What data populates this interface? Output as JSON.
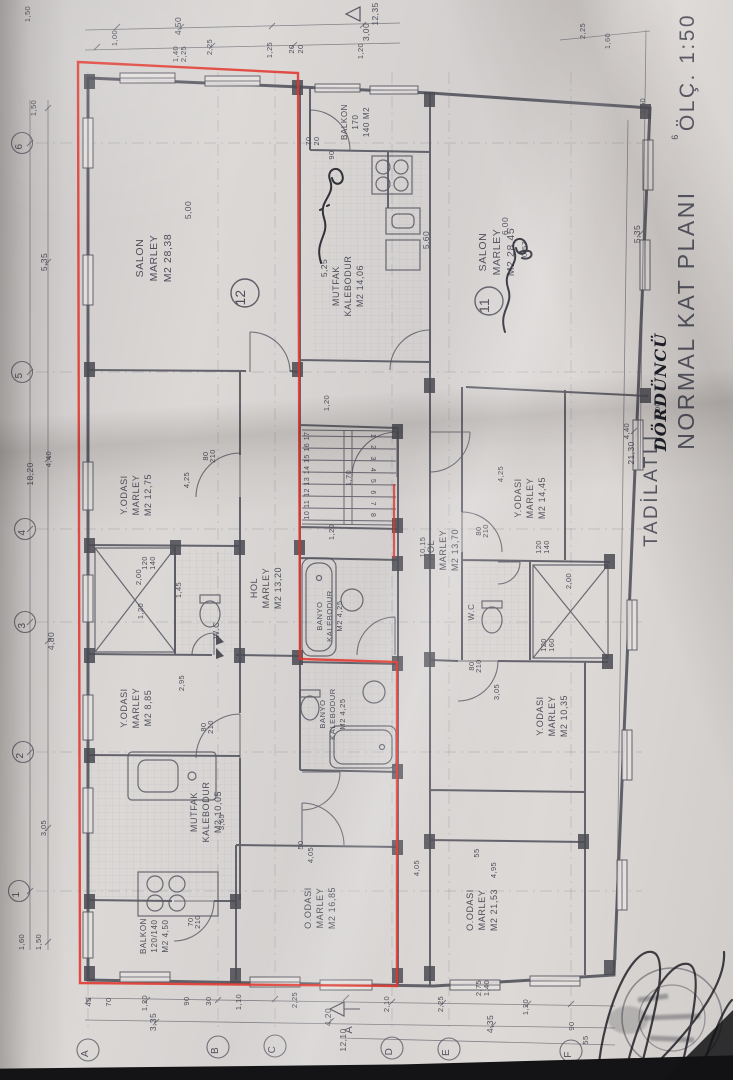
{
  "title": {
    "prefix": "TADİLATLI",
    "handwritten": "DÖRDÜNCÜ",
    "main": "NORMAL KAT PLANI",
    "scale": "ÖLÇ. 1:50"
  },
  "section_marker": {
    "label": "A"
  },
  "apartment_units": [
    {
      "number": "12",
      "x": 245,
      "y": 293
    },
    {
      "number": "11",
      "x": 489,
      "y": 301
    }
  ],
  "rooms": [
    {
      "name": "SALON",
      "material": "MARLEY",
      "area": "M2 28,38",
      "x": 143,
      "y": 258,
      "s": 10.5,
      "lh": 14
    },
    {
      "name": "Y.ODASI",
      "material": "MARLEY",
      "area": "M2 12,75",
      "x": 127,
      "y": 495,
      "s": 9,
      "lh": 12
    },
    {
      "name": "HOL",
      "material": "MARLEY",
      "area": "M2 13,20",
      "x": 257,
      "y": 588,
      "s": 9,
      "lh": 12
    },
    {
      "name": "Y.ODASI",
      "material": "MARLEY",
      "area": "M2 8,85",
      "x": 127,
      "y": 708,
      "s": 9,
      "lh": 12
    },
    {
      "name": "MUTFAK",
      "material": "KALEBODUR",
      "area": "M2 10,05",
      "x": 197,
      "y": 812,
      "s": 9,
      "lh": 12
    },
    {
      "name": "BALKON",
      "material": "120/140",
      "area": "M2 4,50",
      "x": 146,
      "y": 936,
      "s": 8,
      "lh": 11
    },
    {
      "name": "O.ODASI",
      "material": "MARLEY",
      "area": "M2 16,85",
      "x": 311,
      "y": 908,
      "s": 9,
      "lh": 12
    },
    {
      "name": "BALKON",
      "material": "170",
      "area": "140 M2",
      "x": 347,
      "y": 122,
      "s": 8,
      "lh": 11
    },
    {
      "name": "MUTFAK",
      "material": "KALEBODUR",
      "area": "M2 14,06",
      "x": 339,
      "y": 286,
      "s": 9,
      "lh": 12
    },
    {
      "name": "BANYO",
      "material": "KALEBODUR",
      "area": "M2 4,25",
      "x": 322,
      "y": 616,
      "s": 7.5,
      "lh": 10
    },
    {
      "name": "BANYO",
      "material": "KALEBODUR",
      "area": "M2 4,25",
      "x": 325,
      "y": 714,
      "s": 7.5,
      "lh": 10
    },
    {
      "name": "W.C",
      "material": "",
      "area": "",
      "x": 219,
      "y": 630,
      "s": 8,
      "lh": 10
    },
    {
      "name": "SALON",
      "material": "MARLEY",
      "area": "M2 28,45",
      "x": 486,
      "y": 252,
      "s": 10.5,
      "lh": 14
    },
    {
      "name": "HOL",
      "material": "MARLEY",
      "area": "M2 13,70",
      "x": 434,
      "y": 550,
      "s": 9,
      "lh": 12
    },
    {
      "name": "Y.ODASI",
      "material": "MARLEY",
      "area": "M2 14,45",
      "x": 521,
      "y": 498,
      "s": 9,
      "lh": 12
    },
    {
      "name": "Y.ODASI",
      "material": "MARLEY",
      "area": "M2 10,35",
      "x": 543,
      "y": 716,
      "s": 9,
      "lh": 12
    },
    {
      "name": "O.ODASI",
      "material": "MARLEY",
      "area": "M2 21,53",
      "x": 473,
      "y": 910,
      "s": 9,
      "lh": 12
    },
    {
      "name": "W.C",
      "material": "",
      "area": "",
      "x": 474,
      "y": 612,
      "s": 8,
      "lh": 10
    }
  ],
  "dimensions": [
    {
      "t": "1,50",
      "x": 30,
      "y": 14
    },
    {
      "t": "1,00",
      "x": 117,
      "y": 38
    },
    {
      "t": "4,50",
      "x": 181,
      "y": 26,
      "s": 8.5
    },
    {
      "t": "2,25",
      "x": 212,
      "y": 47
    },
    {
      "t": "2,25",
      "x": 186,
      "y": 54
    },
    {
      "t": "1,40",
      "x": 178,
      "y": 54
    },
    {
      "t": "1,25",
      "x": 272,
      "y": 50
    },
    {
      "t": "20",
      "x": 294,
      "y": 49
    },
    {
      "t": "20",
      "x": 303,
      "y": 49
    },
    {
      "t": "1,20",
      "x": 363,
      "y": 51
    },
    {
      "t": "3,00",
      "x": 369,
      "y": 32,
      "s": 8.5
    },
    {
      "t": "12,35",
      "x": 378,
      "y": 14,
      "s": 8.5
    },
    {
      "t": "2,25",
      "x": 585,
      "y": 31
    },
    {
      "t": "1,60",
      "x": 610,
      "y": 41
    },
    {
      "t": "1,50",
      "x": 645,
      "y": 106
    },
    {
      "t": "1,50",
      "x": 36,
      "y": 108
    },
    {
      "t": "5,35",
      "x": 47,
      "y": 262,
      "s": 8.5
    },
    {
      "t": "4,40",
      "x": 51,
      "y": 459
    },
    {
      "t": "18,20",
      "x": 33,
      "y": 474,
      "s": 8.5
    },
    {
      "t": "4,80",
      "x": 54,
      "y": 641,
      "s": 8.5
    },
    {
      "t": "3,05",
      "x": 46,
      "y": 828
    },
    {
      "t": "1,60",
      "x": 24,
      "y": 942
    },
    {
      "t": "1,50",
      "x": 41,
      "y": 942
    },
    {
      "t": "5,35",
      "x": 640,
      "y": 234,
      "s": 8.5
    },
    {
      "t": "4,40",
      "x": 629,
      "y": 431
    },
    {
      "t": "21,30",
      "x": 634,
      "y": 453,
      "s": 8.5
    },
    {
      "t": "6",
      "x": 678,
      "y": 137,
      "s": 9
    },
    {
      "t": "4,00",
      "x": 660,
      "y": 410
    },
    {
      "t": "45",
      "x": 91,
      "y": 1002
    },
    {
      "t": "70",
      "x": 111,
      "y": 1002
    },
    {
      "t": "1,20",
      "x": 147,
      "y": 1003
    },
    {
      "t": "90",
      "x": 189,
      "y": 1001
    },
    {
      "t": "30",
      "x": 211,
      "y": 1001
    },
    {
      "t": "1,10",
      "x": 241,
      "y": 1002
    },
    {
      "t": "2,25",
      "x": 297,
      "y": 1000
    },
    {
      "t": "3,35",
      "x": 156,
      "y": 1022,
      "s": 8.5
    },
    {
      "t": "4,20",
      "x": 331,
      "y": 1017,
      "s": 8.5
    },
    {
      "t": "12,10",
      "x": 346,
      "y": 1040,
      "s": 8.5
    },
    {
      "t": "2,10",
      "x": 389,
      "y": 1004
    },
    {
      "t": "2,25",
      "x": 443,
      "y": 1004
    },
    {
      "t": "1,20",
      "x": 528,
      "y": 1007
    },
    {
      "t": "4,35",
      "x": 493,
      "y": 1024,
      "s": 8.5
    },
    {
      "t": "90",
      "x": 574,
      "y": 1026
    },
    {
      "t": "55",
      "x": 588,
      "y": 1040
    },
    {
      "t": "2,75",
      "x": 481,
      "y": 988
    },
    {
      "t": "1,40",
      "x": 489,
      "y": 988
    },
    {
      "t": "5,00",
      "x": 191,
      "y": 210,
      "s": 8.5
    },
    {
      "t": "6,00",
      "x": 508,
      "y": 226,
      "s": 8.5
    },
    {
      "t": "0,57",
      "x": 527,
      "y": 249
    },
    {
      "t": "5,25",
      "x": 327,
      "y": 268,
      "s": 8.5
    },
    {
      "t": "5,60",
      "x": 429,
      "y": 240,
      "s": 8.5
    },
    {
      "t": "4,25",
      "x": 189,
      "y": 480
    },
    {
      "t": "2,95",
      "x": 184,
      "y": 683
    },
    {
      "t": "3,65",
      "x": 224,
      "y": 822
    },
    {
      "t": "4,05",
      "x": 313,
      "y": 855
    },
    {
      "t": "50",
      "x": 303,
      "y": 845
    },
    {
      "t": "4,25",
      "x": 503,
      "y": 474
    },
    {
      "t": "3,05",
      "x": 499,
      "y": 692
    },
    {
      "t": "4,05",
      "x": 419,
      "y": 868
    },
    {
      "t": "4,95",
      "x": 496,
      "y": 870
    },
    {
      "t": "55",
      "x": 479,
      "y": 853
    },
    {
      "t": "10,15",
      "x": 425,
      "y": 547
    },
    {
      "t": "1,20",
      "x": 329,
      "y": 403
    },
    {
      "t": "1,70",
      "x": 351,
      "y": 478
    },
    {
      "t": "1,20",
      "x": 334,
      "y": 532
    },
    {
      "t": "2,00",
      "x": 141,
      "y": 577
    },
    {
      "t": "1,20",
      "x": 143,
      "y": 611
    },
    {
      "t": "1,45",
      "x": 181,
      "y": 590
    },
    {
      "t": "120",
      "x": 147,
      "y": 563
    },
    {
      "t": "140",
      "x": 155,
      "y": 563
    },
    {
      "t": "2,00",
      "x": 571,
      "y": 581
    },
    {
      "t": "120",
      "x": 541,
      "y": 547
    },
    {
      "t": "140",
      "x": 549,
      "y": 547
    },
    {
      "t": "120",
      "x": 546,
      "y": 645
    },
    {
      "t": "160",
      "x": 554,
      "y": 645
    },
    {
      "t": "80",
      "x": 208,
      "y": 456
    },
    {
      "t": "210",
      "x": 215,
      "y": 456
    },
    {
      "t": "80",
      "x": 206,
      "y": 727
    },
    {
      "t": "210",
      "x": 213,
      "y": 727
    },
    {
      "t": "70",
      "x": 193,
      "y": 922
    },
    {
      "t": "210",
      "x": 200,
      "y": 922
    },
    {
      "t": "80",
      "x": 474,
      "y": 666
    },
    {
      "t": "210",
      "x": 481,
      "y": 666
    },
    {
      "t": "80",
      "x": 481,
      "y": 531
    },
    {
      "t": "210",
      "x": 488,
      "y": 531
    },
    {
      "t": "70",
      "x": 311,
      "y": 141
    },
    {
      "t": "20",
      "x": 319,
      "y": 141
    },
    {
      "t": "90",
      "x": 334,
      "y": 155
    }
  ],
  "stairs": {
    "left": [
      "17",
      "16",
      "15",
      "14",
      "13",
      "12",
      "11",
      "10"
    ],
    "right": [
      "1",
      "2",
      "3",
      "4",
      "5",
      "6",
      "7",
      "8"
    ]
  },
  "axes": {
    "rows": [
      {
        "label": "6",
        "x": 22,
        "y": 143
      },
      {
        "label": "5",
        "x": 22,
        "y": 372
      },
      {
        "label": "4",
        "x": 25,
        "y": 529
      },
      {
        "label": "3",
        "x": 25,
        "y": 622
      },
      {
        "label": "2",
        "x": 23,
        "y": 752
      },
      {
        "label": "1",
        "x": 19,
        "y": 891
      }
    ],
    "cols": [
      {
        "label": "A",
        "x": 88,
        "y": 1050
      },
      {
        "label": "B",
        "x": 218,
        "y": 1047
      },
      {
        "label": "C",
        "x": 275,
        "y": 1046
      },
      {
        "label": "D",
        "x": 392,
        "y": 1048
      },
      {
        "label": "E",
        "x": 449,
        "y": 1049
      },
      {
        "label": "F",
        "x": 571,
        "y": 1051
      }
    ]
  }
}
